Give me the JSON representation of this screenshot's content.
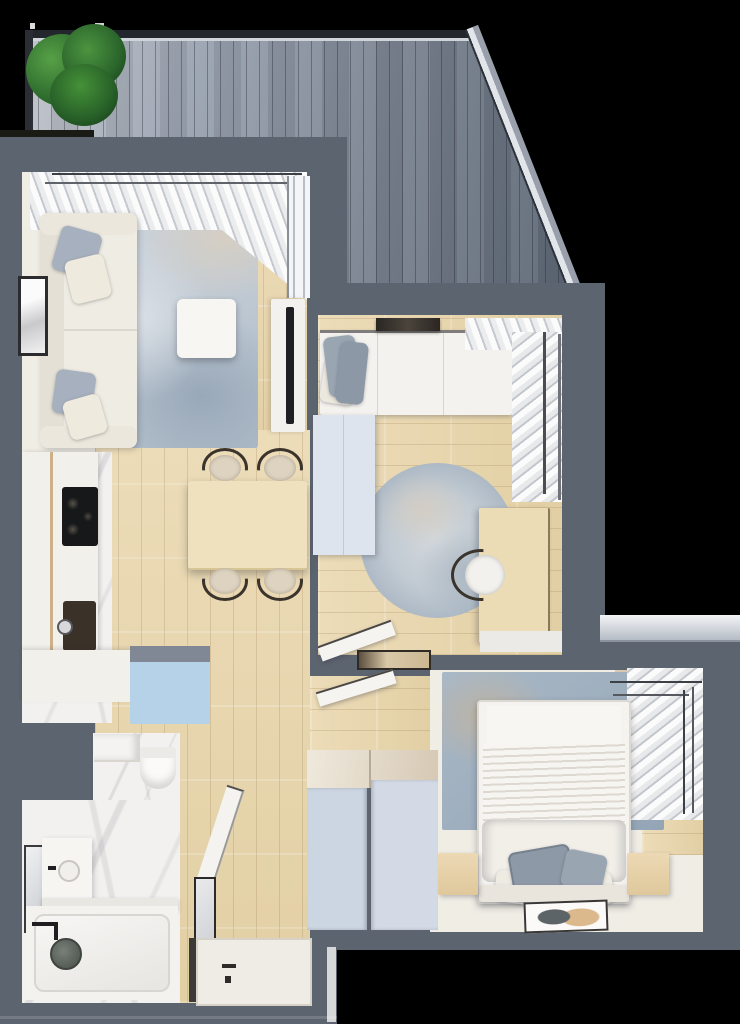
{
  "scene": {
    "kind": "apartment-floor-plan-3d-top-view",
    "no_visible_text": true
  },
  "colors": {
    "bg": "#000000",
    "wall": "#5c6470",
    "deck_light": "#c0c4ca",
    "deck_dark": "#5d6775",
    "deck_trim": "#23262c",
    "deck_edge": "#e2e5ea",
    "plant_dark": "#1d4a1f",
    "plant_mid": "#2f6d2e",
    "plant_light": "#57a047",
    "wood": "#e9d8b2",
    "cream": "#f0ede5",
    "marble": "#f3f1ef",
    "rug_living": "#aebbc8",
    "rug_beige": "#d8cec0",
    "rug_kids": "#c6cfd6",
    "rug_master": "#9fb0c0",
    "pillow_gray": "#98a3b1",
    "accent_blue": "#b6d2e8",
    "wardrobe_blue": "#ccd5e2",
    "kids_wardrobe": "#dee4ee",
    "table_wood": "#efe1bd",
    "desk_wood": "#ecdcb6",
    "chair_dark": "#3a342c",
    "cooktop_black": "#17181a",
    "sink_dark": "#3a3128",
    "tv_black": "#1e1f22",
    "tan": "#d9c9ae",
    "ledge": "#dfe3e8"
  },
  "rooms": {
    "terrace": {
      "label": "Terrace",
      "features": [
        "gray wood deck planks",
        "diagonal outer edge",
        "potted green plant"
      ]
    },
    "living_room": {
      "label": "Living room",
      "furniture": [
        "cream sofa with gray pillows",
        "blue-gray rug",
        "white coffee table",
        "TV console with wall TV",
        "wall art",
        "curtained window",
        "terrace door"
      ]
    },
    "kitchen": {
      "label": "Kitchen",
      "furniture": [
        "L-shaped white counter",
        "black cooktop",
        "dark sink",
        "light blue cabinet"
      ]
    },
    "dining_area": {
      "label": "Dining area",
      "furniture": [
        "light wood table",
        "four dark-frame chairs"
      ]
    },
    "kids_bedroom": {
      "label": "Small bedroom",
      "furniture": [
        "single bed with gray pillows",
        "dark wall shelf",
        "corner window blinds",
        "round rug",
        "wood desk",
        "desk chair",
        "light wardrobe",
        "open door",
        "doormat"
      ]
    },
    "master_bedroom": {
      "label": "Master bedroom",
      "furniture": [
        "double bed with gray pillows",
        "two wood nightstands",
        "distressed blue rug",
        "window blinds",
        "wardrobe cabinets",
        "floor mat art",
        "open door",
        "outer window ledge"
      ]
    },
    "bathroom": {
      "label": "Bathroom",
      "furniture": [
        "toilet",
        "washer cabinet",
        "vanity with round sink",
        "wall mirror",
        "bathtub",
        "black faucet",
        "gray shower head",
        "shelf"
      ]
    },
    "hallway": {
      "label": "Hallway",
      "furniture": [
        "entrance door with handle",
        "tall mirror",
        "open bathroom door"
      ]
    }
  }
}
